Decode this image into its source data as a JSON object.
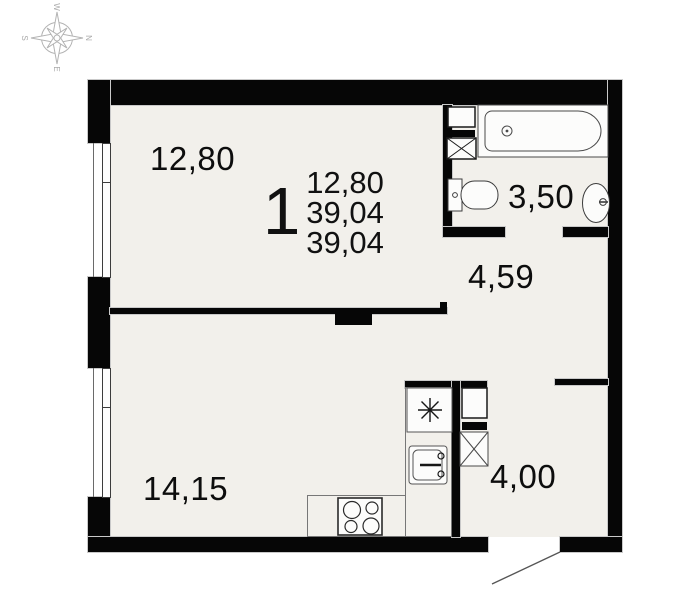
{
  "unit": {
    "rooms_count": "1",
    "living_area": "12,80",
    "total_area": "39,04",
    "declared_area": "39,04"
  },
  "rooms": {
    "living": "12,80",
    "bathroom": "3,50",
    "hallway": "4,59",
    "kitchen_living": "14,15",
    "entry": "4,00"
  },
  "compass": {
    "north": "N",
    "east": "E",
    "south": "S",
    "west": "W"
  },
  "colors": {
    "wall": "#060606",
    "floor": "#f2f0eb",
    "fixture_line": "#444444",
    "compass_gray": "#b3b3b3"
  }
}
